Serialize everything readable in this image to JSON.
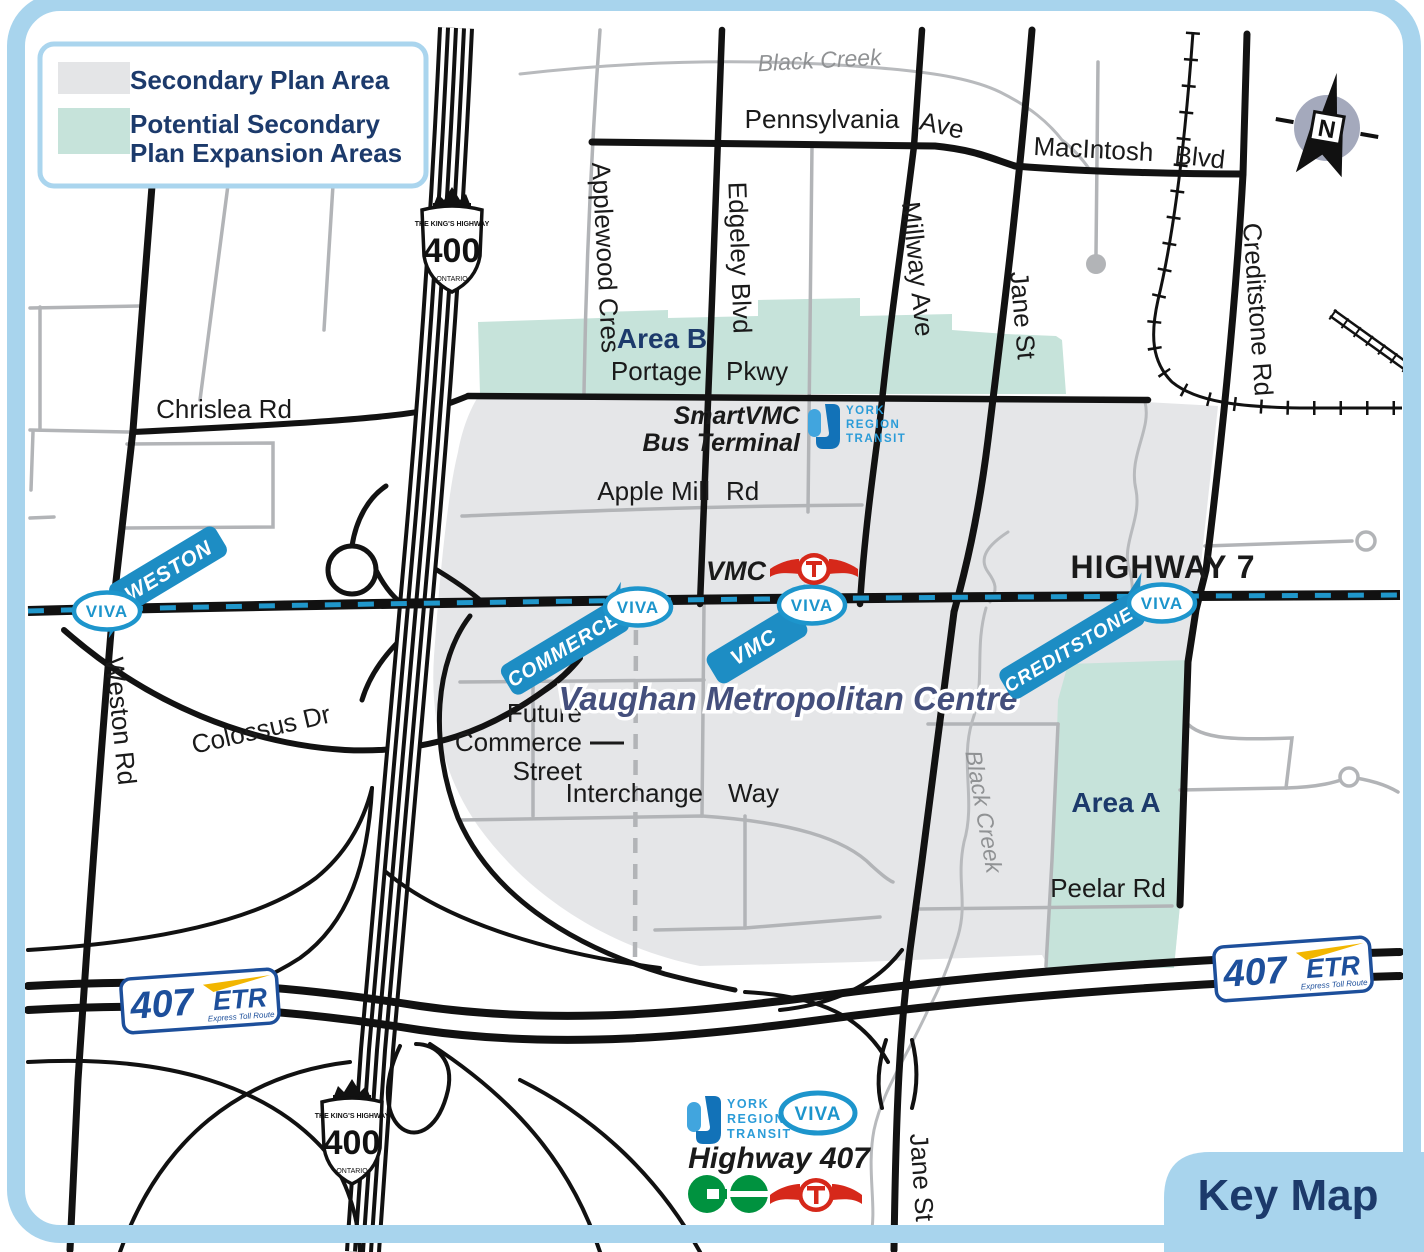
{
  "legend": {
    "item1": "Secondary Plan Area",
    "item2_line1": "Potential Secondary",
    "item2_line2": "Plan Expansion Areas"
  },
  "key_map_label": "Key Map",
  "compass": {
    "n": "N"
  },
  "labels": {
    "plan": "Vaughan Metropolitan Centre",
    "area_a": "Area A",
    "area_b": "Area B",
    "highway7": "HIGHWAY 7"
  },
  "shield": {
    "top": "THE KING'S HIGHWAY",
    "num": "400",
    "bottom": "ONTARIO"
  },
  "etr": {
    "num": "407",
    "abbr": "ETR",
    "tagline": "Express Toll Route"
  },
  "viva": {
    "word": "VIVA"
  },
  "stations": {
    "weston": "WESTON",
    "commerce": "COMMERCE",
    "vmc": "VMC",
    "creditstone": "CREDITSTONE"
  },
  "terminal": {
    "line1": "SmartVMC",
    "line2": "Bus Terminal"
  },
  "yrt": {
    "l1": "YORK",
    "l2": "REGION",
    "l3": "TRANSIT"
  },
  "ttc_vmc_label": "VMC",
  "highway407_label": "Highway 407",
  "creek": "Black Creek",
  "roads": {
    "pennsylvania": "Pennsylvania",
    "ave": "Ave",
    "macintosh": "MacIntosh",
    "blvd": "Blvd",
    "applewood": "Applewood Cres",
    "edgeley": "Edgeley Blvd",
    "millway": "Millway Ave",
    "jane": "Jane St",
    "creditstone": "Creditstone Rd",
    "chrislea": "Chrislea Rd",
    "weston": "Weston Rd",
    "colossus": "Colossus Dr",
    "portage": "Portage",
    "pkwy": "Pkwy",
    "apple_mill": "Apple Mill",
    "rd": "Rd",
    "future1": "Future",
    "future2": "Commerce",
    "future3": "Street",
    "interchange": "Interchange",
    "way": "Way",
    "peelar": "Peelar Rd"
  },
  "colors": {
    "frame_blue": "#a8d4ed",
    "plan_area_gray": "#e5e6e8",
    "expansion_green": "#c6e3da",
    "navy": "#1c3a6b",
    "viva_blue": "#1d95cc",
    "station_tag_blue": "#1d8dc4",
    "etr_blue": "#1d4f9b",
    "etr_yellow": "#f2b600",
    "ttc_red": "#d6281a",
    "go_green": "#00923f"
  }
}
